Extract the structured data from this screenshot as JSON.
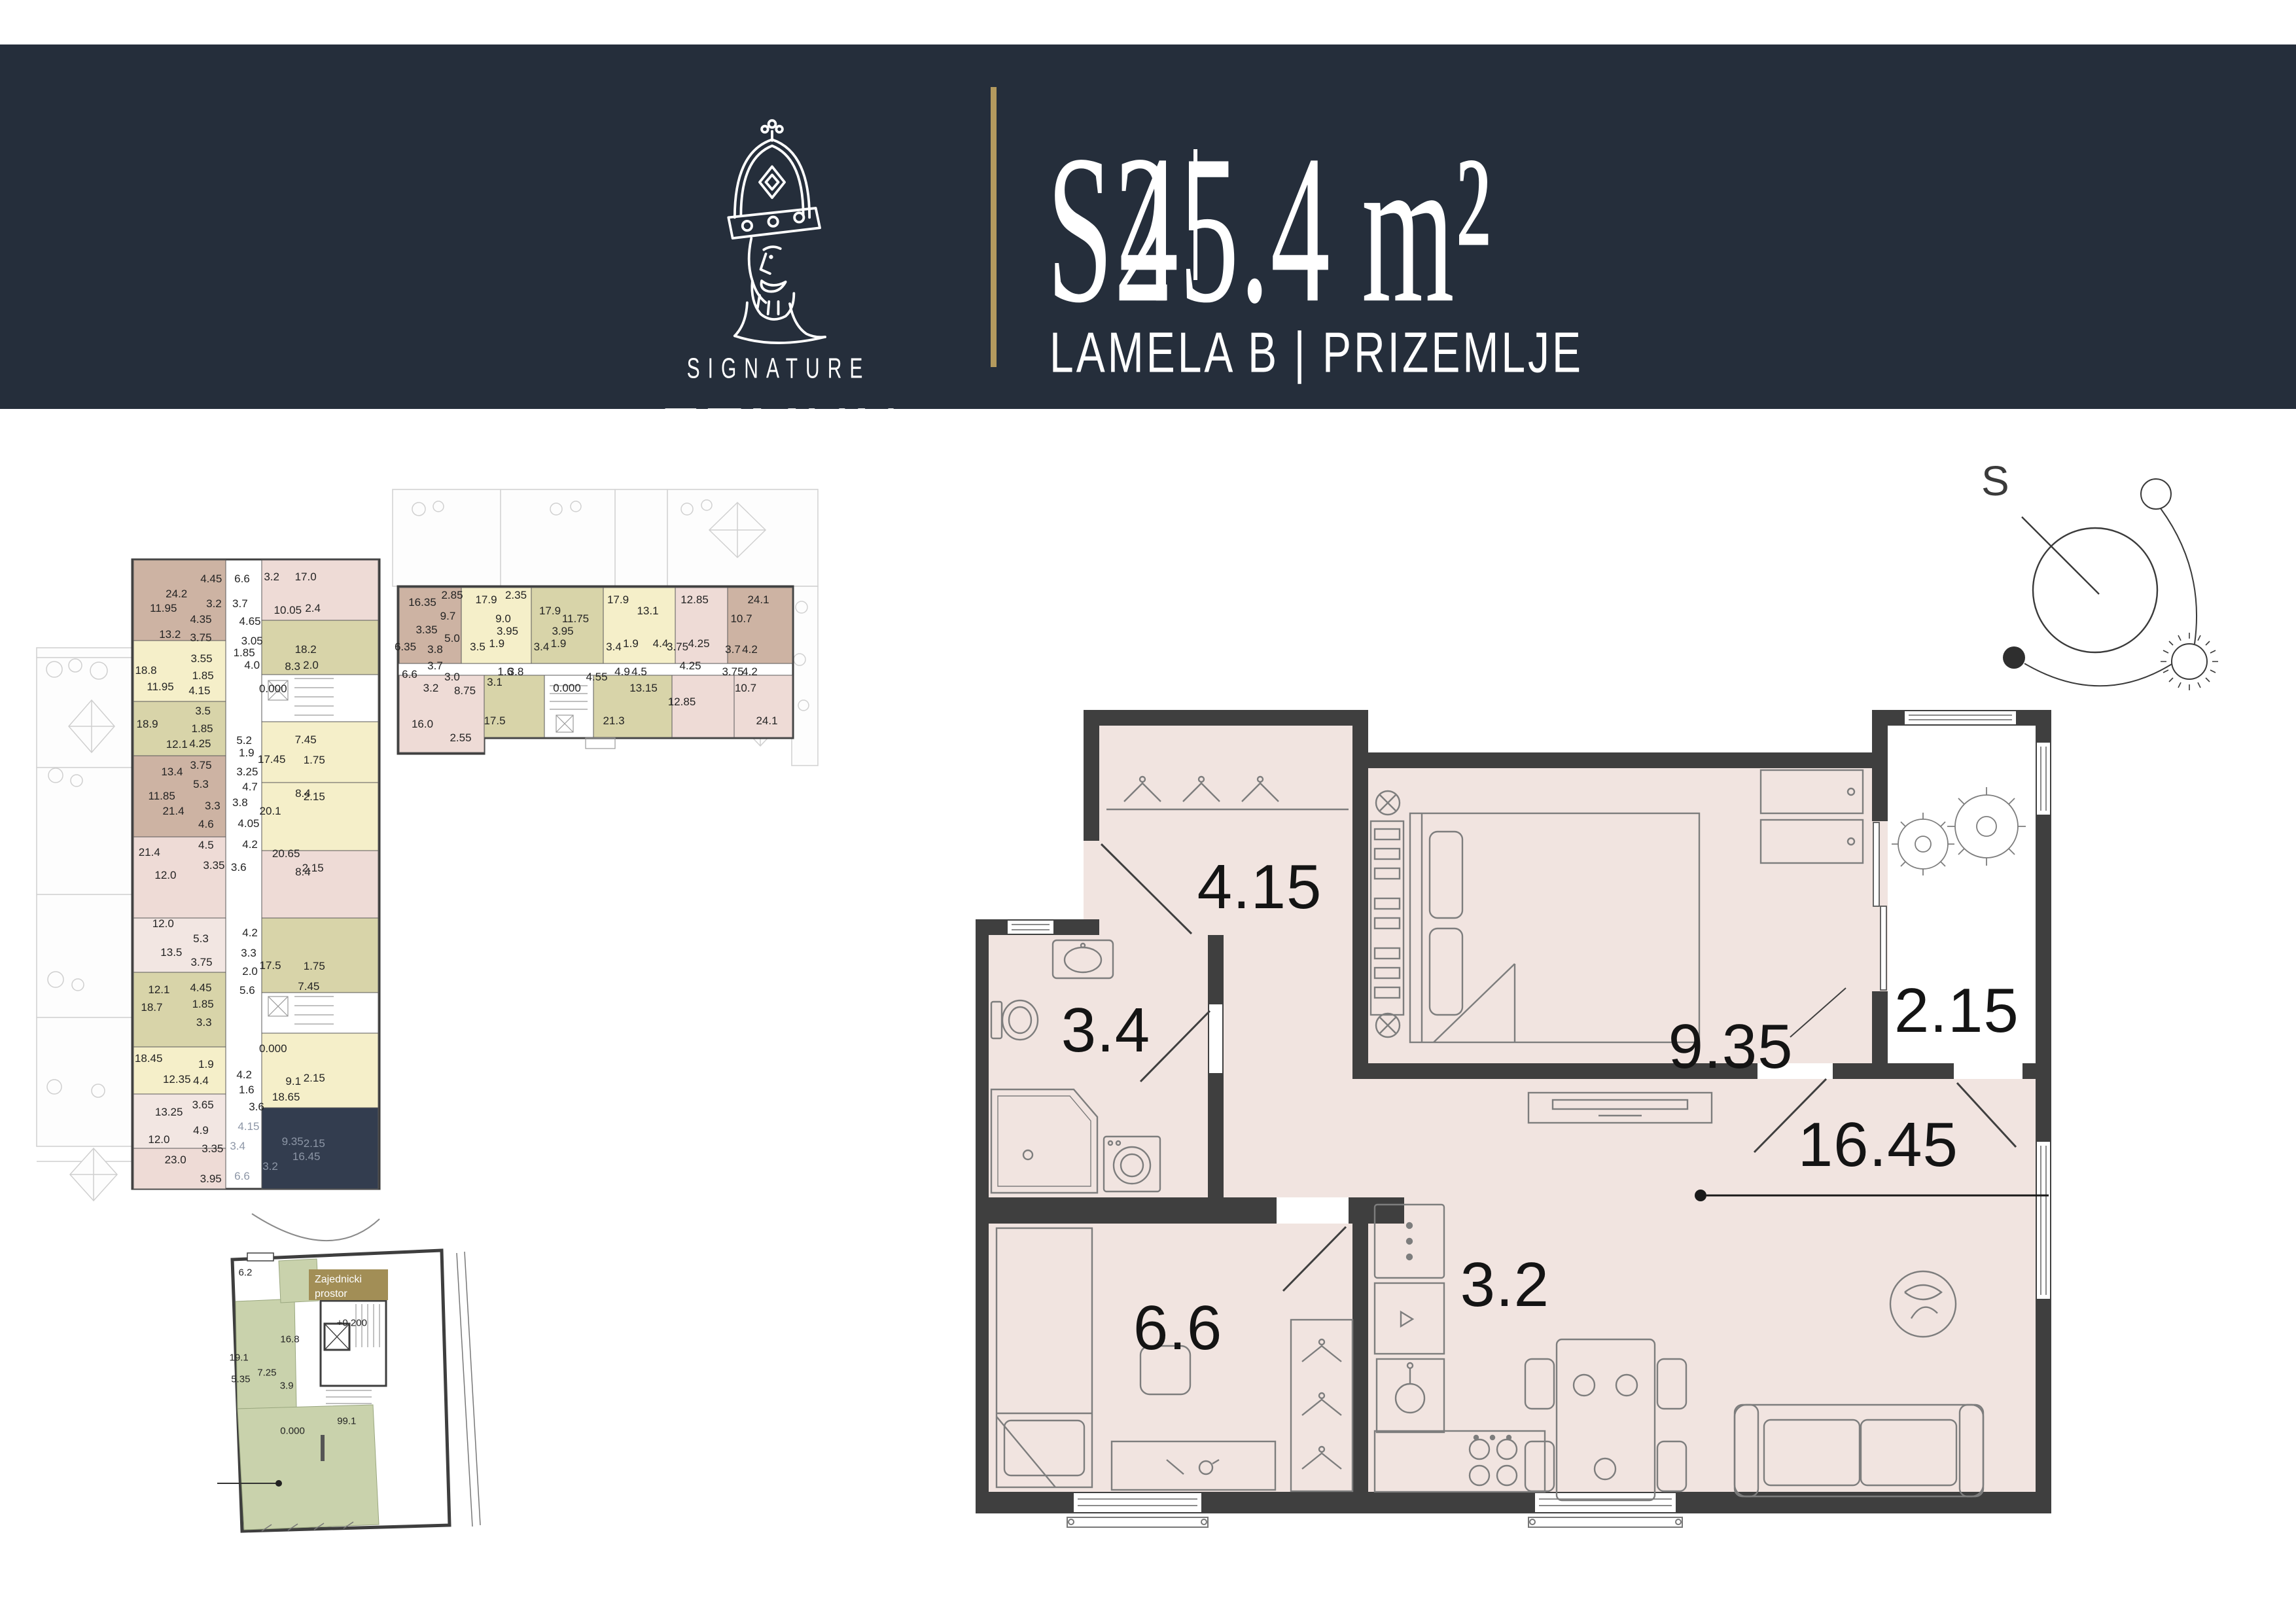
{
  "header": {
    "logo_icon": "king-crown-icon",
    "logo_line1": "SIGNATURE",
    "logo_line2": "ZEMUN",
    "unit_code": "S2",
    "divider": "|",
    "area": "45.4 m²",
    "location": "LAMELA B | PRIZEMLJE"
  },
  "compass": {
    "north_label": "S"
  },
  "colors": {
    "band": "#252e3b",
    "gold": "#b49a5e",
    "badge_gold": "#a28e56",
    "floor": "#f1e4e0",
    "wall": "#3f3f3f",
    "highlight_unit": "#333d4f",
    "mini_brown": "#cdb3a3",
    "mini_yellow": "#f5efc9",
    "mini_olive": "#d8d4a9",
    "mini_pink": "#eedbd6",
    "mini_lightpink": "#f2e6e2",
    "green": "#c9d2ac"
  },
  "main_plan": {
    "labels": [
      {
        "t": "4.15",
        "x": 26.4,
        "y": 21.5
      },
      {
        "t": "3.4",
        "x": 12.1,
        "y": 38.9
      },
      {
        "t": "9.35",
        "x": 70.2,
        "y": 40.9
      },
      {
        "t": "2.15",
        "x": 91.2,
        "y": 36.5
      },
      {
        "t": "16.45",
        "x": 83.9,
        "y": 52.8
      },
      {
        "t": "6.6",
        "x": 18.8,
        "y": 75.0
      },
      {
        "t": "3.2",
        "x": 49.2,
        "y": 69.8
      }
    ]
  },
  "site_plan_left": {
    "labels": [
      {
        "t": "24.2",
        "x": 40.9,
        "y": 5.1
      },
      {
        "t": "4.45",
        "x": 51.0,
        "y": 2.9
      },
      {
        "t": "3.2",
        "x": 51.8,
        "y": 6.6
      },
      {
        "t": "11.95",
        "x": 37.1,
        "y": 7.2
      },
      {
        "t": "4.35",
        "x": 48.0,
        "y": 8.9
      },
      {
        "t": "13.2",
        "x": 39.0,
        "y": 11.1
      },
      {
        "t": "3.75",
        "x": 48.0,
        "y": 11.6
      },
      {
        "t": "6.6",
        "x": 60.0,
        "y": 2.9
      },
      {
        "t": "3.2",
        "x": 68.6,
        "y": 2.6
      },
      {
        "t": "17.0",
        "x": 78.5,
        "y": 2.6
      },
      {
        "t": "3.7",
        "x": 59.4,
        "y": 6.6
      },
      {
        "t": "10.05",
        "x": 73.3,
        "y": 7.5
      },
      {
        "t": "2.4",
        "x": 80.6,
        "y": 7.2
      },
      {
        "t": "4.65",
        "x": 62.3,
        "y": 9.2
      },
      {
        "t": "3.05",
        "x": 62.9,
        "y": 12.1
      },
      {
        "t": "18.2",
        "x": 78.5,
        "y": 13.3
      },
      {
        "t": "1.85",
        "x": 60.6,
        "y": 13.8
      },
      {
        "t": "4.0",
        "x": 62.9,
        "y": 15.7
      },
      {
        "t": "8.3",
        "x": 74.7,
        "y": 15.8
      },
      {
        "t": "2.0",
        "x": 80.0,
        "y": 15.7
      },
      {
        "t": "18.8",
        "x": 32.0,
        "y": 16.4
      },
      {
        "t": "3.55",
        "x": 48.2,
        "y": 14.7
      },
      {
        "t": "1.85",
        "x": 48.6,
        "y": 17.2
      },
      {
        "t": "11.95",
        "x": 36.2,
        "y": 18.8
      },
      {
        "t": "4.15",
        "x": 47.6,
        "y": 19.4
      },
      {
        "t": "0.000",
        "x": 69.0,
        "y": 19.1
      },
      {
        "t": "18.9",
        "x": 32.4,
        "y": 24.3
      },
      {
        "t": "3.5",
        "x": 48.6,
        "y": 22.4
      },
      {
        "t": "1.85",
        "x": 48.4,
        "y": 25.0
      },
      {
        "t": "12.1",
        "x": 41.0,
        "y": 27.3
      },
      {
        "t": "4.25",
        "x": 47.8,
        "y": 27.2
      },
      {
        "t": "5.2",
        "x": 60.6,
        "y": 26.8
      },
      {
        "t": "7.45",
        "x": 78.5,
        "y": 26.7
      },
      {
        "t": "1.9",
        "x": 61.3,
        "y": 28.6
      },
      {
        "t": "17.45",
        "x": 68.6,
        "y": 29.6
      },
      {
        "t": "1.75",
        "x": 81.0,
        "y": 29.7
      },
      {
        "t": "3.75",
        "x": 48.0,
        "y": 30.4
      },
      {
        "t": "13.4",
        "x": 39.6,
        "y": 31.4
      },
      {
        "t": "3.25",
        "x": 61.5,
        "y": 31.4
      },
      {
        "t": "11.85",
        "x": 36.6,
        "y": 35.0
      },
      {
        "t": "5.3",
        "x": 48.0,
        "y": 33.2
      },
      {
        "t": "4.7",
        "x": 62.3,
        "y": 33.6
      },
      {
        "t": "8.4",
        "x": 77.7,
        "y": 34.6
      },
      {
        "t": "2.15",
        "x": 81.0,
        "y": 35.1
      },
      {
        "t": "21.4",
        "x": 40.0,
        "y": 37.2
      },
      {
        "t": "3.3",
        "x": 51.4,
        "y": 36.4
      },
      {
        "t": "3.8",
        "x": 59.4,
        "y": 35.9
      },
      {
        "t": "20.1",
        "x": 68.2,
        "y": 37.2
      },
      {
        "t": "4.6",
        "x": 49.5,
        "y": 39.1
      },
      {
        "t": "4.05",
        "x": 61.9,
        "y": 39.0
      },
      {
        "t": "4.5",
        "x": 49.5,
        "y": 42.2
      },
      {
        "t": "4.2",
        "x": 62.3,
        "y": 42.1
      },
      {
        "t": "21.4",
        "x": 33.0,
        "y": 43.3
      },
      {
        "t": "20.65",
        "x": 72.8,
        "y": 43.5
      },
      {
        "t": "3.35",
        "x": 51.8,
        "y": 45.2
      },
      {
        "t": "3.6",
        "x": 59.0,
        "y": 45.5
      },
      {
        "t": "12.0",
        "x": 37.7,
        "y": 46.7
      },
      {
        "t": "2.15",
        "x": 80.6,
        "y": 45.6
      },
      {
        "t": "8.4",
        "x": 77.7,
        "y": 46.2
      },
      {
        "t": "12.0",
        "x": 37.0,
        "y": 53.8
      },
      {
        "t": "5.3",
        "x": 48.0,
        "y": 56.0
      },
      {
        "t": "4.2",
        "x": 62.3,
        "y": 55.2
      },
      {
        "t": "13.5",
        "x": 39.4,
        "y": 58.1
      },
      {
        "t": "3.3",
        "x": 61.9,
        "y": 58.2
      },
      {
        "t": "3.75",
        "x": 48.2,
        "y": 59.5
      },
      {
        "t": "17.5",
        "x": 68.2,
        "y": 60.0
      },
      {
        "t": "1.75",
        "x": 81.0,
        "y": 60.1
      },
      {
        "t": "2.0",
        "x": 62.3,
        "y": 60.9
      },
      {
        "t": "12.1",
        "x": 35.8,
        "y": 63.6
      },
      {
        "t": "4.45",
        "x": 48.0,
        "y": 63.3
      },
      {
        "t": "5.6",
        "x": 61.5,
        "y": 63.7
      },
      {
        "t": "7.45",
        "x": 79.4,
        "y": 63.1
      },
      {
        "t": "18.7",
        "x": 33.7,
        "y": 66.2
      },
      {
        "t": "1.85",
        "x": 48.6,
        "y": 65.7
      },
      {
        "t": "3.3",
        "x": 48.9,
        "y": 68.4
      },
      {
        "t": "0.000",
        "x": 69.0,
        "y": 72.3
      },
      {
        "t": "18.45",
        "x": 32.8,
        "y": 73.7
      },
      {
        "t": "1.9",
        "x": 49.5,
        "y": 74.6
      },
      {
        "t": "12.35",
        "x": 41.0,
        "y": 76.8
      },
      {
        "t": "4.4",
        "x": 48.0,
        "y": 77.0
      },
      {
        "t": "4.2",
        "x": 60.6,
        "y": 76.1
      },
      {
        "t": "2.15",
        "x": 81.0,
        "y": 76.6
      },
      {
        "t": "9.1",
        "x": 74.9,
        "y": 77.1
      },
      {
        "t": "1.6",
        "x": 61.3,
        "y": 78.4
      },
      {
        "t": "18.65",
        "x": 72.8,
        "y": 79.4
      },
      {
        "t": "13.25",
        "x": 38.7,
        "y": 81.6
      },
      {
        "t": "3.65",
        "x": 48.6,
        "y": 80.6
      },
      {
        "t": "3.6",
        "x": 64.2,
        "y": 80.9
      },
      {
        "t": "12.0",
        "x": 35.8,
        "y": 85.7
      },
      {
        "t": "4.9",
        "x": 48.0,
        "y": 84.3
      },
      {
        "t": "23.0",
        "x": 40.6,
        "y": 88.7
      },
      {
        "t": "3.35",
        "x": 51.4,
        "y": 87.1
      },
      {
        "t": "3.95",
        "x": 50.9,
        "y": 91.5
      },
      {
        "t": "4.15",
        "x": 61.9,
        "y": 83.8,
        "c": "dim"
      },
      {
        "t": "9.35",
        "x": 74.7,
        "y": 86.0,
        "c": "dim"
      },
      {
        "t": "2.15",
        "x": 81.0,
        "y": 86.3,
        "c": "dim"
      },
      {
        "t": "3.4",
        "x": 58.7,
        "y": 86.7,
        "c": "dim"
      },
      {
        "t": "16.45",
        "x": 78.7,
        "y": 88.2,
        "c": "dim"
      },
      {
        "t": "6.6",
        "x": 60.0,
        "y": 91.1,
        "c": "dim"
      },
      {
        "t": "3.2",
        "x": 68.2,
        "y": 89.7,
        "c": "dim"
      }
    ]
  },
  "site_plan_top": {
    "labels": [
      {
        "t": "16.35",
        "x": 7,
        "y": 41
      },
      {
        "t": "2.85",
        "x": 14,
        "y": 38.5
      },
      {
        "t": "9.7",
        "x": 13,
        "y": 46
      },
      {
        "t": "3.35",
        "x": 8,
        "y": 51
      },
      {
        "t": "5.0",
        "x": 14,
        "y": 54
      },
      {
        "t": "17.9",
        "x": 22,
        "y": 40
      },
      {
        "t": "2.35",
        "x": 29,
        "y": 38.5
      },
      {
        "t": "9.0",
        "x": 26,
        "y": 47
      },
      {
        "t": "3.95",
        "x": 27,
        "y": 51.5
      },
      {
        "t": "3.5",
        "x": 20,
        "y": 57
      },
      {
        "t": "1.9",
        "x": 24.5,
        "y": 56
      },
      {
        "t": "17.9",
        "x": 37,
        "y": 44
      },
      {
        "t": "11.75",
        "x": 43,
        "y": 47
      },
      {
        "t": "3.95",
        "x": 40,
        "y": 51.5
      },
      {
        "t": "3.4",
        "x": 35,
        "y": 57
      },
      {
        "t": "1.9",
        "x": 39,
        "y": 56
      },
      {
        "t": "17.9",
        "x": 53,
        "y": 40
      },
      {
        "t": "13.1",
        "x": 60,
        "y": 44
      },
      {
        "t": "4.4",
        "x": 63,
        "y": 56
      },
      {
        "t": "3.4",
        "x": 52,
        "y": 57
      },
      {
        "t": "1.9",
        "x": 56,
        "y": 56
      },
      {
        "t": "12.85",
        "x": 71,
        "y": 40
      },
      {
        "t": "3.75",
        "x": 67,
        "y": 57
      },
      {
        "t": "4.25",
        "x": 72,
        "y": 56
      },
      {
        "t": "24.1",
        "x": 86,
        "y": 40
      },
      {
        "t": "10.7",
        "x": 82,
        "y": 47
      },
      {
        "t": "3.7",
        "x": 80,
        "y": 58
      },
      {
        "t": "4.2",
        "x": 84,
        "y": 58
      },
      {
        "t": "3.75",
        "x": 80,
        "y": 66
      },
      {
        "t": "4.2",
        "x": 84,
        "y": 66
      },
      {
        "t": "6.35",
        "x": 3,
        "y": 57
      },
      {
        "t": "3.8",
        "x": 10,
        "y": 58
      },
      {
        "t": "3.7",
        "x": 10,
        "y": 64
      },
      {
        "t": "6.6",
        "x": 4,
        "y": 67
      },
      {
        "t": "3.2",
        "x": 9,
        "y": 72
      },
      {
        "t": "3.0",
        "x": 14,
        "y": 68
      },
      {
        "t": "8.75",
        "x": 17,
        "y": 73
      },
      {
        "t": "16.0",
        "x": 7,
        "y": 85
      },
      {
        "t": "2.55",
        "x": 16,
        "y": 90
      },
      {
        "t": "3.1",
        "x": 24,
        "y": 70
      },
      {
        "t": "1.6",
        "x": 26.5,
        "y": 66
      },
      {
        "t": "3.8",
        "x": 29,
        "y": 66
      },
      {
        "t": "17.5",
        "x": 24,
        "y": 84
      },
      {
        "t": "0.000",
        "x": 41,
        "y": 72
      },
      {
        "t": "4.55",
        "x": 48,
        "y": 68
      },
      {
        "t": "4.9",
        "x": 54,
        "y": 66
      },
      {
        "t": "4.5",
        "x": 58,
        "y": 66
      },
      {
        "t": "13.15",
        "x": 59,
        "y": 72
      },
      {
        "t": "21.3",
        "x": 52,
        "y": 84
      },
      {
        "t": "4.25",
        "x": 70,
        "y": 64
      },
      {
        "t": "12.85",
        "x": 68,
        "y": 77
      },
      {
        "t": "10.7",
        "x": 83,
        "y": 72
      },
      {
        "t": "24.1",
        "x": 88,
        "y": 84
      }
    ]
  },
  "site_plan_bottom": {
    "badge_line1": "Zajednicki",
    "badge_line2": "prostor",
    "labels": [
      {
        "t": "6.2",
        "x": 10.1,
        "y": 11.4
      },
      {
        "t": "16.8",
        "x": 25.4,
        "y": 33.6
      },
      {
        "t": "19.1",
        "x": 7.9,
        "y": 39.8
      },
      {
        "t": "7.25",
        "x": 17.5,
        "y": 44.9
      },
      {
        "t": "5.35",
        "x": 8.5,
        "y": 47.0
      },
      {
        "t": "3.9",
        "x": 24.3,
        "y": 49.2
      },
      {
        "t": "+0.200",
        "x": 46.7,
        "y": 28.2
      },
      {
        "t": "0.000",
        "x": 26.3,
        "y": 64.3
      },
      {
        "t": "99.1",
        "x": 44.9,
        "y": 61.1
      }
    ]
  }
}
